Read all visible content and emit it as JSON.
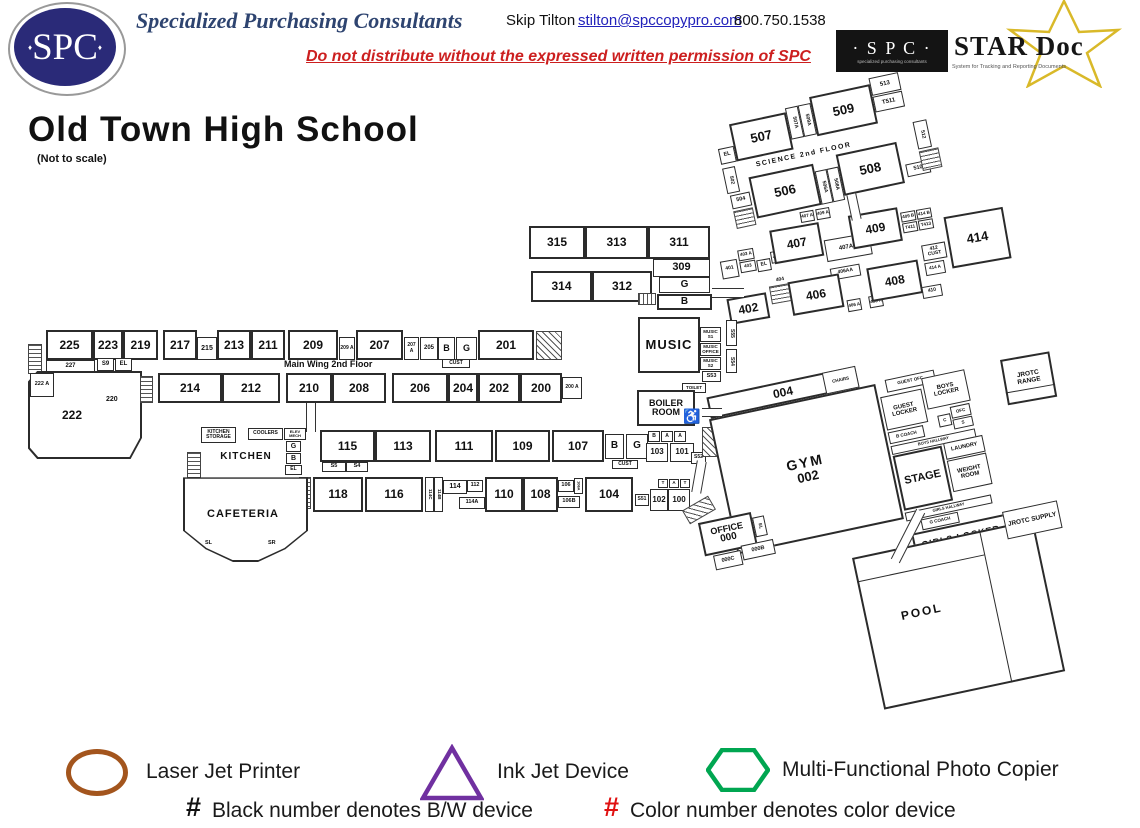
{
  "header": {
    "logo": "SPC",
    "company": "Specialized Purchasing Consultants",
    "contact": "Skip Tilton",
    "email": "stilton@spccopypro.com",
    "phone": "800.750.1538",
    "warning": "Do not distribute without the expressed written permission of SPC",
    "stardoc": {
      "spc": "· S P C ·",
      "spc_sub": "specialized purchasing consultants",
      "name": "STAR Doc",
      "tagline": "System for Tracking and Reporting Documents",
      "star_color": "#d9b929"
    }
  },
  "title": "Old Town High School",
  "subtitle": "(Not to scale)",
  "colors": {
    "navy": "#2a2a78",
    "header_blue": "#2e4470",
    "red": "#cc1f1f",
    "link": "#2222bb",
    "wall": "#2b2b2b"
  },
  "legend": {
    "laser": "Laser Jet Printer",
    "inkjet": "Ink Jet Device",
    "mfp": "Multi-Functional Photo Copier",
    "hash": "#",
    "bw_note": "Black number denotes B/W device",
    "color_note": "Color number denotes color device",
    "laser_color": "#a3551d",
    "inkjet_color": "#7030a0",
    "mfp_color": "#00a651",
    "hash_red": "#e01111",
    "hash_black": "#111111"
  },
  "plan": {
    "science": {
      "title": "SCIENCE 2nd FLOOR",
      "r507": "507",
      "r509": "509",
      "r506": "506",
      "r508": "508",
      "r507a": "507A",
      "r509a": "509A",
      "r506a": "506A",
      "r508a": "508A",
      "r513": "513",
      "t511": "T511",
      "r512": "512",
      "r510": "510",
      "r504": "504",
      "r502": "502",
      "el": "EL"
    },
    "wing400": {
      "r401": "401",
      "r403a": "403 A",
      "r403": "403",
      "el": "EL",
      "r407b": "407 B",
      "r402": "402",
      "r404": "404",
      "r407": "407",
      "r407a": "407 A",
      "r409a": "409 A",
      "r407aa": "407AA",
      "r409": "409",
      "r409b": "409 B",
      "r414b": "414 B",
      "t411": "T411",
      "t413": "T413",
      "r414": "414",
      "r412cust": "412 CUST",
      "r414a": "414 A",
      "r410": "410",
      "r406aa": "406AA",
      "r406": "406",
      "r406a": "406 A",
      "r408a": "408 A",
      "r408": "408"
    },
    "wing300": {
      "r315": "315",
      "r313": "313",
      "r311": "311",
      "r309": "309",
      "g": "G",
      "b": "B",
      "r314": "314",
      "r312": "312"
    },
    "music": {
      "main": "MUSIC",
      "s1": "MUSIC S1",
      "office": "MUSIC OFFICE",
      "s2": "MUSIC S2",
      "s53": "S53",
      "s55": "S55",
      "s54": "S54"
    },
    "boiler": {
      "label": "BOILER ROOM",
      "toilet": "TOILET",
      "handicap_icon": "♿"
    },
    "main2": {
      "title": "Main Wing 2nd Floor",
      "r225": "225",
      "r223": "223",
      "r219": "219",
      "r217": "217",
      "r215": "215",
      "r213": "213",
      "r211": "211",
      "r209": "209",
      "r209a": "209 A",
      "r207": "207",
      "r207a": "207 A",
      "r205": "205",
      "b": "B",
      "g": "G",
      "cust": "CUST",
      "r201": "201",
      "r227": "227",
      "s9": "S9",
      "el": "EL",
      "r222a": "222 A",
      "r220": "220",
      "r222": "222",
      "r214": "214",
      "r212": "212",
      "r210": "210",
      "r208": "208",
      "r206": "206",
      "r204": "204",
      "r202": "202",
      "r200": "200",
      "r200a": "200 A"
    },
    "wing100": {
      "r115": "115",
      "r113": "113",
      "r111": "111",
      "r109": "109",
      "r107": "107",
      "b": "B",
      "g": "G",
      "cust": "CUST",
      "sb": "B",
      "sa1": "A",
      "sa2": "A",
      "r103": "103",
      "r101": "101",
      "s52": "S52",
      "s5": "S5",
      "s4": "S4",
      "r118": "118",
      "r116": "116",
      "r114c": "114C",
      "r114b": "114B",
      "r114": "114",
      "r112": "112",
      "r114a": "114A",
      "r110": "110",
      "r108": "108",
      "r106": "106",
      "r106a": "106A",
      "r106b": "106B",
      "r104": "104",
      "s51": "S51",
      "r102": "102",
      "r100": "100",
      "t1": "T",
      "a1": "A",
      "t2": "T"
    },
    "cafeteria": {
      "storage": "KITCHEN STORAGE",
      "coolers": "COOLERS",
      "elev": "ELEV MECH",
      "g": "G",
      "b": "B",
      "el": "EL",
      "kitchen": "KITCHEN",
      "s8": "S8",
      "cust": "CUST",
      "s7": "S7",
      "main": "CAFETERIA",
      "sl": "SL",
      "sr": "SR"
    },
    "gym": {
      "corridor": "004",
      "chairs": "CHAIRS",
      "name": "GYM",
      "number": "002",
      "guest_ofc": "GUEST OFC",
      "guest_locker": "GUEST LOCKER",
      "boys_locker": "BOYS LOCKER",
      "ofc": "OFC",
      "s": "S",
      "c": "C",
      "b_coach": "B COACH",
      "boys_hallway": "BOYS HALLWAY",
      "stage": "STAGE",
      "laundry": "LAUNDRY",
      "weight": "WEIGHT ROOM",
      "girls_hallway": "GIRLS HALLWAY",
      "g_coach": "G COACH",
      "girls_locker": "GIRLS LOCKER"
    },
    "office": {
      "main": "OFFICE",
      "number": "000",
      "el": "EL",
      "r000c": "000C",
      "r000b": "000B"
    },
    "pool": "POOL",
    "jrotc_range": "JROTC RANGE",
    "jrotc_supply": "JROTC SUPPLY"
  }
}
